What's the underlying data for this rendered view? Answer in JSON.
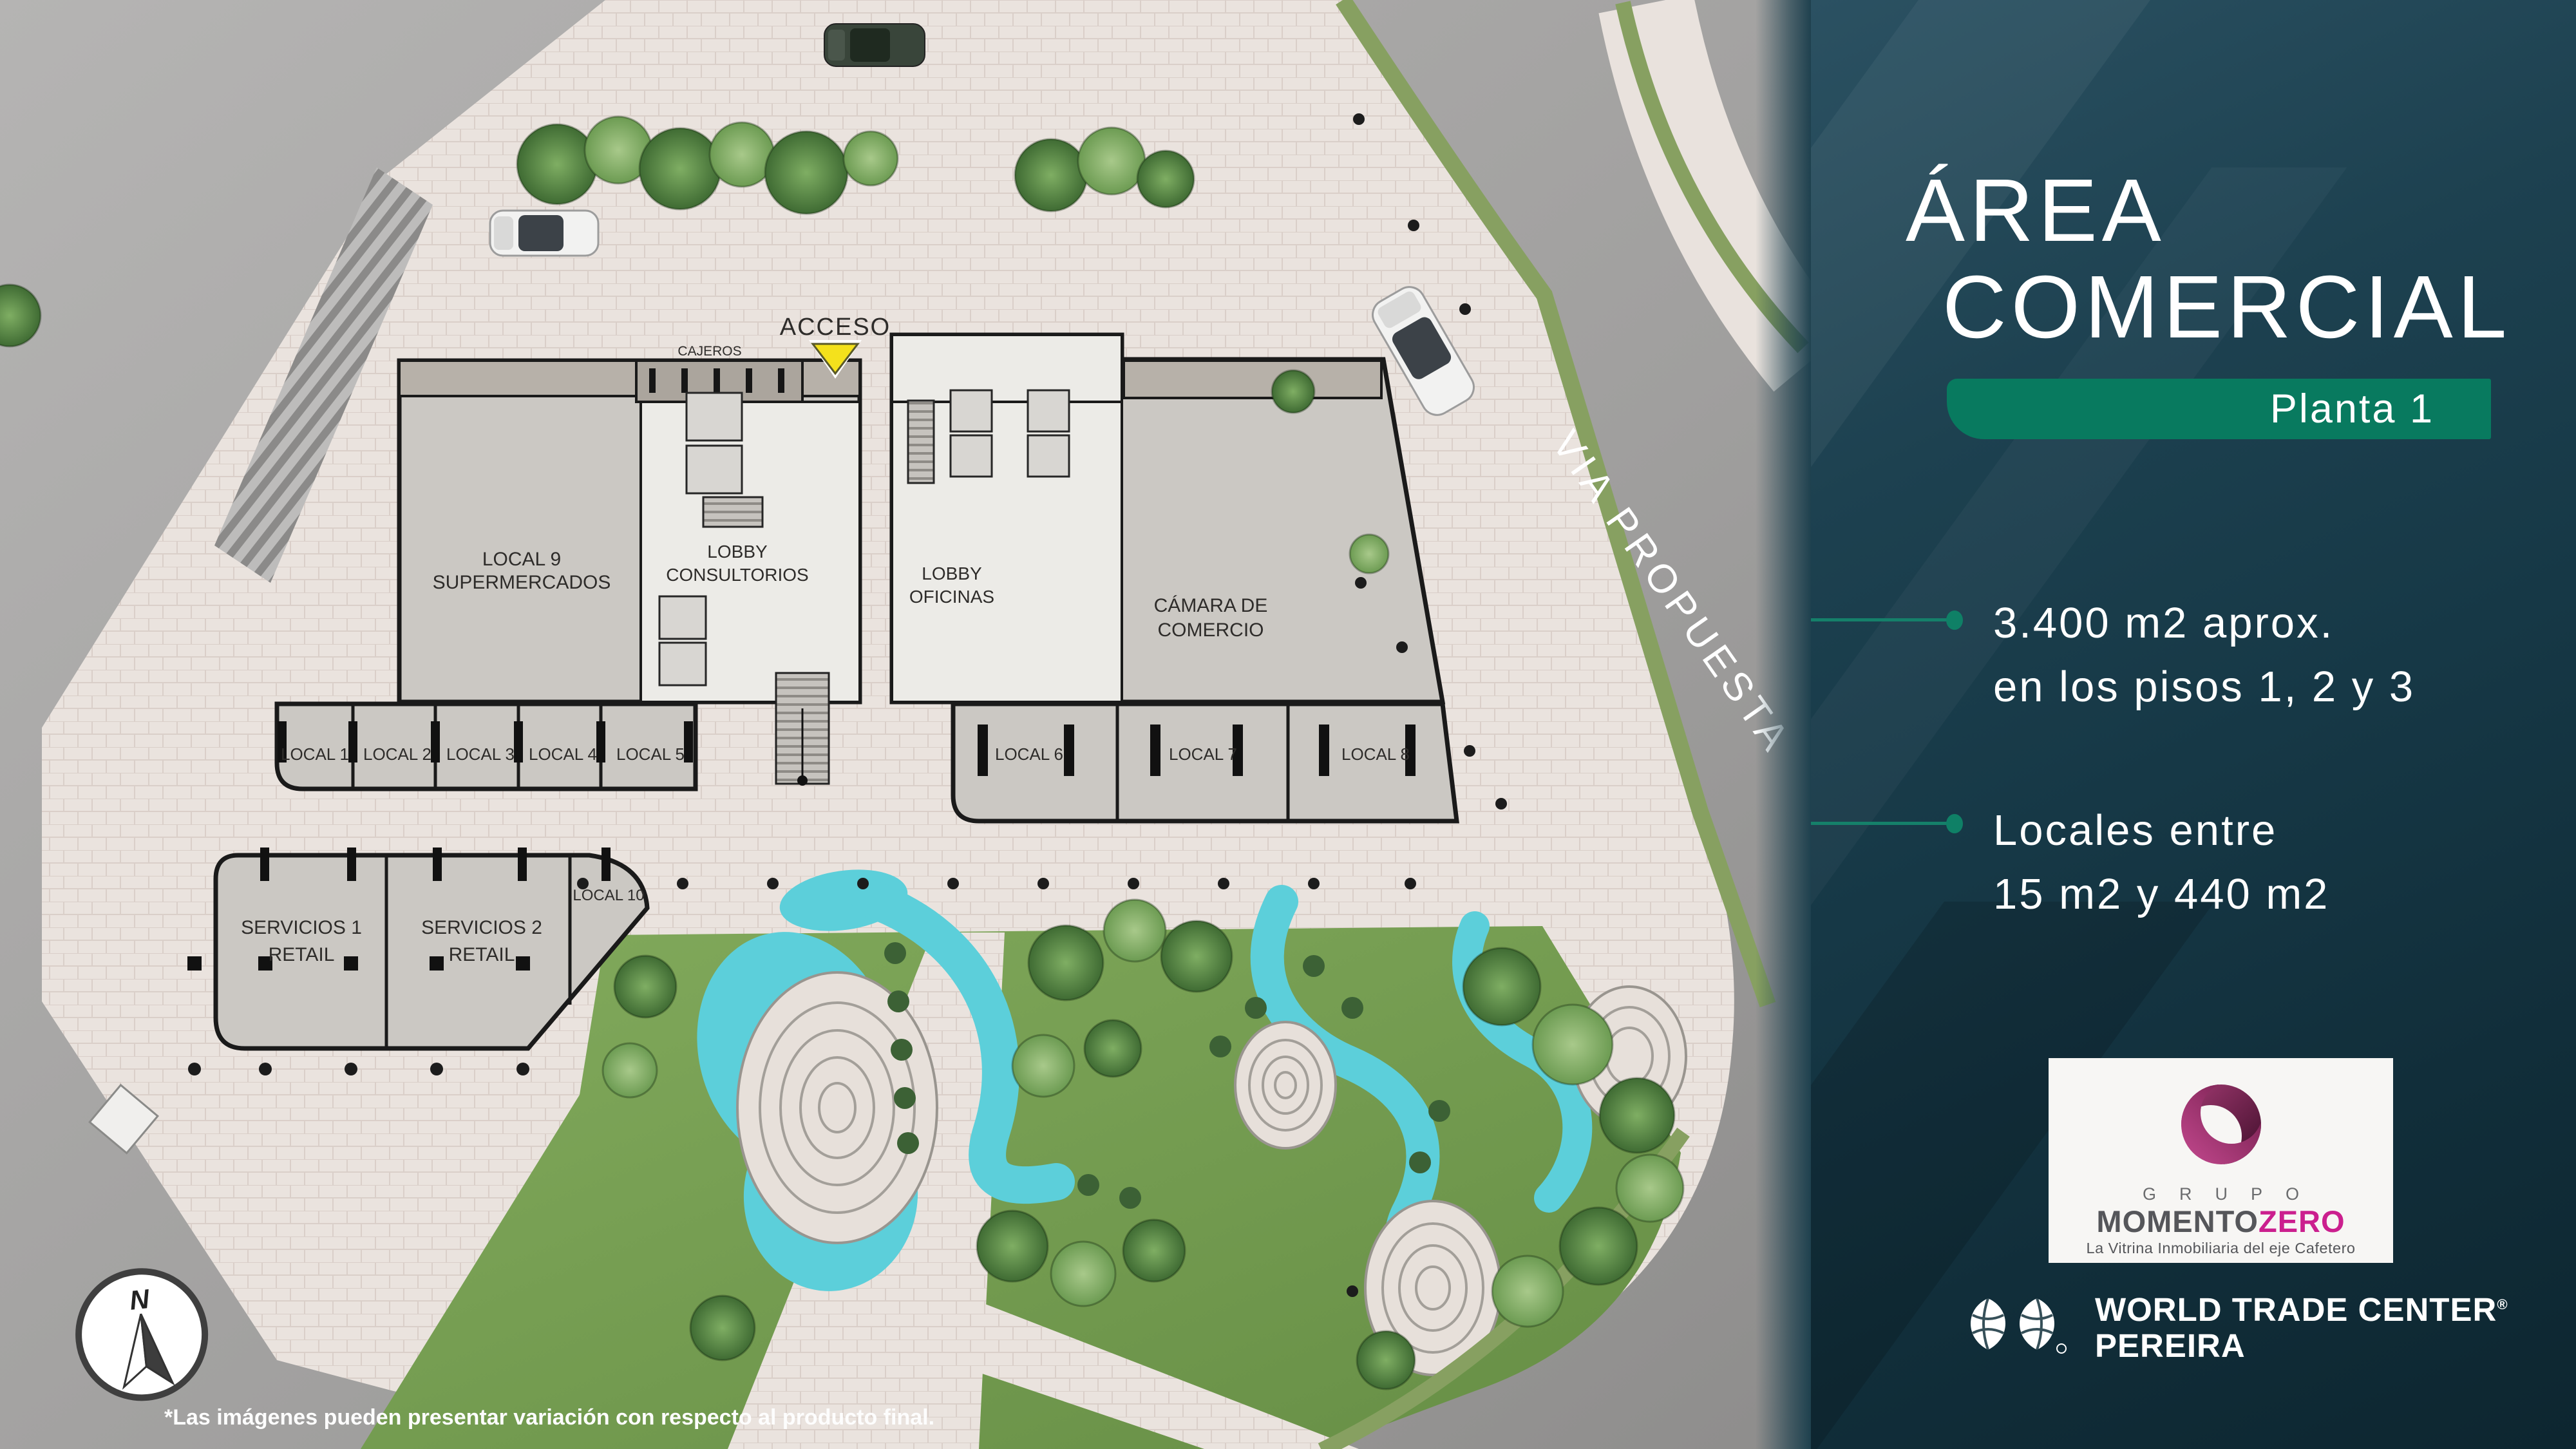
{
  "panel": {
    "title_line1": "ÁREA",
    "title_line2": "COMERCIAL",
    "badge": "Planta 1",
    "bullets": [
      {
        "line1": "3.400 m2 aprox.",
        "line2": "en los pisos 1, 2 y 3"
      },
      {
        "line1": "Locales entre",
        "line2": "15 m2 y 440 m2"
      }
    ],
    "logo": {
      "grupo": "GRUPO",
      "momento": "MOMENTO",
      "zero": "ZERO",
      "tagline": "La Vitrina Inmobiliaria del eje Cafetero"
    },
    "wtc": {
      "name": "WORLD TRADE CENTER",
      "reg": "®",
      "city": "PEREIRA"
    }
  },
  "plan": {
    "labels": {
      "acceso": "ACCESO",
      "cajeros": "CAJEROS",
      "lobby": "LOBBY",
      "consultorios": "CONSULTORIOS",
      "oficinas": "OFICINAS",
      "camara1": "CÁMARA DE",
      "camara2": "COMERCIO",
      "local9a": "LOCAL 9",
      "local9b": "SUPERMERCADOS",
      "servicios1": "SERVICIOS 1",
      "servicios2": "SERVICIOS 2",
      "retail": "RETAIL",
      "local10": "LOCAL 10",
      "via": "VIA PROPUESTA",
      "compass_n": "N",
      "locals": [
        "LOCAL 1",
        "LOCAL 2",
        "LOCAL 3",
        "LOCAL 4",
        "LOCAL 5",
        "LOCAL 6",
        "LOCAL 7",
        "LOCAL 8"
      ]
    },
    "disclaimer": "*Las imágenes pueden presentar variación con respecto al producto final."
  },
  "colors": {
    "accent_green": "#087a5f",
    "panel_teal": "#16333f",
    "water": "#5ccfda",
    "grass": "#76a050",
    "plaza": "#eae3de",
    "road": "#a4a3a2",
    "zero_magenta": "#cb1f8e"
  }
}
